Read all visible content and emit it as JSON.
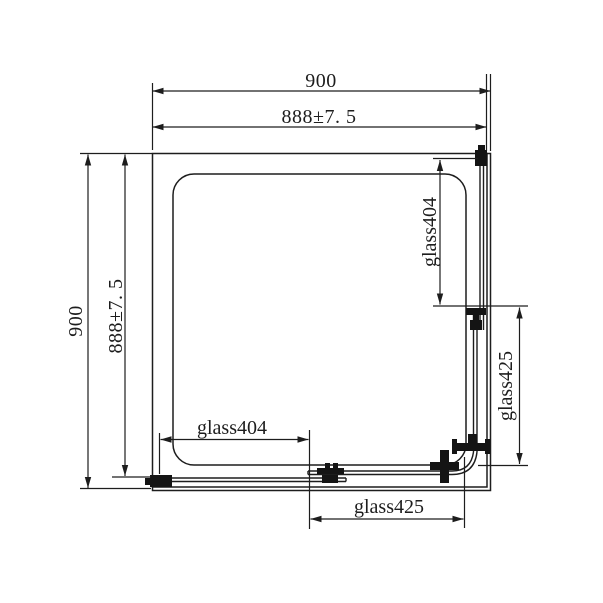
{
  "page": {
    "background": "#ffffff",
    "ink_color": "#1d1d1d"
  },
  "drawing": {
    "dim_top_outer": "900",
    "dim_top_inner": "888±7. 5",
    "dim_left_outer": "900",
    "dim_left_inner": "888±7. 5",
    "label_right_upper_glass": "glass404",
    "label_right_lower_glass": "glass425",
    "label_bottom_left_glass": "glass404",
    "label_bottom_right_glass": "glass425"
  }
}
